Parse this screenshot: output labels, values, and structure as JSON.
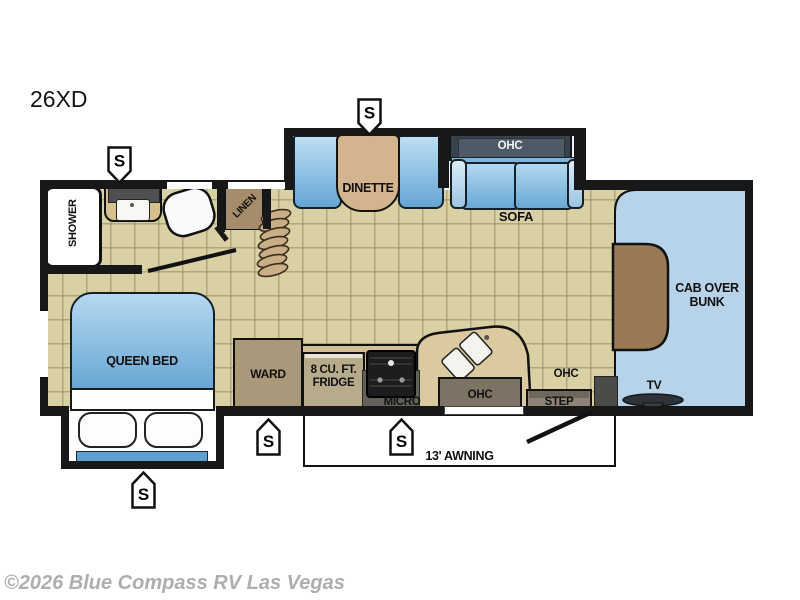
{
  "title": {
    "model": "26XD"
  },
  "watermark": "©2026 Blue Compass RV Las Vegas",
  "labels": {
    "shower": "SHOWER",
    "linen": "LINEN",
    "dinette": "DINETTE",
    "ohc_sofa": "OHC",
    "sofa": "SOFA",
    "cab_over_bunk": "CAB OVER BUNK",
    "queen_bed": "QUEEN BED",
    "ward": "WARD",
    "fridge": "8 CU. FT. FRIDGE",
    "micro": "MICRO",
    "ohc_kitchen": "OHC",
    "ohc_entry": "OHC",
    "step": "STEP",
    "tv": "TV",
    "awning": "13' AWNING"
  },
  "markers": [
    {
      "label": "S",
      "location": "bath-sink",
      "direction": "down"
    },
    {
      "label": "S",
      "location": "dinette-slide",
      "direction": "down"
    },
    {
      "label": "S",
      "location": "queen-bed-slide",
      "direction": "up"
    },
    {
      "label": "S",
      "location": "wardrobe",
      "direction": "up"
    },
    {
      "label": "S",
      "location": "microwave",
      "direction": "up"
    }
  ],
  "colors": {
    "floor_tan": "#d9d0a4",
    "seat_blue": "#8fc0e4",
    "cab_blue": "#b7d3e9",
    "bunk_brown": "#9a7a54",
    "cabinet_brown": "#a99879",
    "wall_black": "#181818"
  }
}
